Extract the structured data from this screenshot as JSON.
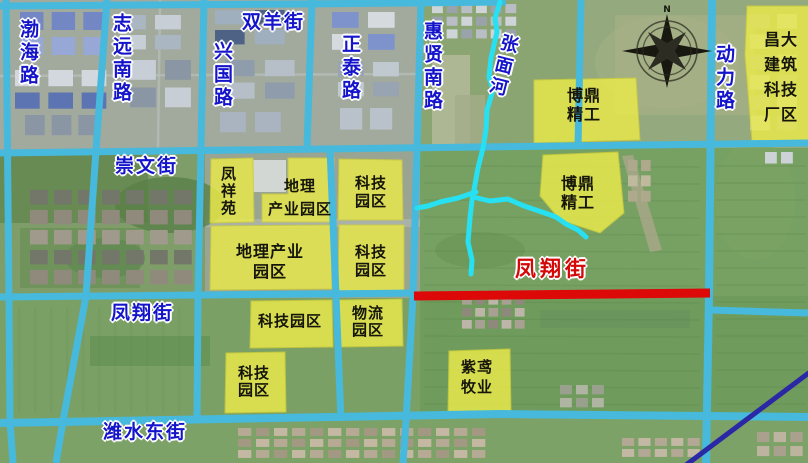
{
  "map": {
    "colors": {
      "road": "#46b9dc",
      "river": "#27e0f2",
      "red_road": "#dd0808",
      "street_text": "#1414cb",
      "street_text_red": "#d40808",
      "area_fill": "#e9e94b",
      "area_stroke": "#cdcd3a",
      "area_text": "#15150b",
      "highway": "#2b28a6",
      "compass": "#181810"
    },
    "streets": [
      {
        "id": "bohai-road",
        "text": "渤海路",
        "orient": "v",
        "x": 17,
        "y": 19,
        "size": 19
      },
      {
        "id": "zhiyuan-south-road",
        "text": "志远南路",
        "orient": "v",
        "x": 110,
        "y": 13,
        "size": 19
      },
      {
        "id": "xingguo-road",
        "text": "兴国路",
        "orient": "v",
        "x": 211,
        "y": 41,
        "size": 19
      },
      {
        "id": "shuangyang-street",
        "text": "双羊街",
        "orient": "h",
        "x": 242,
        "y": 11,
        "size": 19
      },
      {
        "id": "zhengtai-road",
        "text": "正泰路",
        "orient": "v",
        "x": 339,
        "y": 34,
        "size": 19
      },
      {
        "id": "huixian-south-road",
        "text": "惠贤南路",
        "orient": "v",
        "x": 421,
        "y": 21,
        "size": 19
      },
      {
        "id": "zhangmian-river",
        "text": "张面河",
        "orient": "v",
        "x": 499,
        "y": 34,
        "size": 18,
        "rotate": 14
      },
      {
        "id": "dongli-road",
        "text": "动力路",
        "orient": "v",
        "x": 713,
        "y": 44,
        "size": 19
      },
      {
        "id": "chongwen-street",
        "text": "崇文街",
        "orient": "h",
        "x": 115,
        "y": 155,
        "size": 19
      },
      {
        "id": "fengxiang-street-west",
        "text": "凤翔街",
        "orient": "h",
        "x": 111,
        "y": 302,
        "size": 19
      },
      {
        "id": "fengxiang-street-planned",
        "text": "凤翔街",
        "orient": "h",
        "x": 515,
        "y": 257,
        "size": 21,
        "red": true
      },
      {
        "id": "weishui-east-street",
        "text": "潍水东街",
        "orient": "h",
        "x": 103,
        "y": 421,
        "size": 19
      }
    ],
    "roads": [
      {
        "id": "shuangyang-street-road",
        "points": [
          [
            0,
            6
          ],
          [
            300,
            4
          ],
          [
            506,
            2
          ]
        ],
        "w": 7
      },
      {
        "id": "chongwen-street-road",
        "points": [
          [
            0,
            153
          ],
          [
            400,
            148
          ],
          [
            808,
            143
          ]
        ],
        "w": 7
      },
      {
        "id": "fengxiang-street-road",
        "points": [
          [
            0,
            297
          ],
          [
            416,
            293
          ]
        ],
        "w": 7
      },
      {
        "id": "east-connector-road",
        "points": [
          [
            711,
            310
          ],
          [
            808,
            313
          ]
        ],
        "w": 7
      },
      {
        "id": "weishui-east-street-road",
        "points": [
          [
            0,
            423
          ],
          [
            500,
            414
          ],
          [
            808,
            417
          ]
        ],
        "w": 8
      },
      {
        "id": "bohai-road-road",
        "points": [
          [
            6,
            0
          ],
          [
            9,
            300
          ],
          [
            10,
            421
          ],
          [
            13,
            463
          ]
        ],
        "w": 7
      },
      {
        "id": "zhiyuan-south-road-road",
        "points": [
          [
            107,
            0
          ],
          [
            96,
            150
          ],
          [
            86,
            296
          ],
          [
            63,
            421
          ],
          [
            56,
            463
          ]
        ],
        "w": 7
      },
      {
        "id": "xingguo-road-road",
        "points": [
          [
            204,
            0
          ],
          [
            201,
            148
          ],
          [
            198,
            296
          ],
          [
            197,
            421
          ]
        ],
        "w": 7
      },
      {
        "id": "zhengtai-road-north",
        "points": [
          [
            312,
            0
          ],
          [
            307,
            148
          ]
        ],
        "w": 7
      },
      {
        "id": "zhengtai-road-south",
        "points": [
          [
            330,
            148
          ],
          [
            336,
            296
          ],
          [
            341,
            421
          ]
        ],
        "w": 7
      },
      {
        "id": "huixian-south-road-road",
        "points": [
          [
            421,
            0
          ],
          [
            417,
            148
          ],
          [
            413,
            296
          ],
          [
            406,
            421
          ],
          [
            403,
            463
          ]
        ],
        "w": 7
      },
      {
        "id": "north-connector-road",
        "points": [
          [
            581,
            0
          ],
          [
            578,
            147
          ]
        ],
        "w": 7
      },
      {
        "id": "dongli-road-road",
        "points": [
          [
            712,
            0
          ],
          [
            709,
            296
          ],
          [
            706,
            463
          ]
        ],
        "w": 8
      }
    ],
    "red_road": {
      "id": "fengxiang-street-planned-road",
      "points": [
        [
          414,
          296
        ],
        [
          710,
          293
        ]
      ],
      "w": 9
    },
    "highway": {
      "id": "highway-diagonal",
      "points": [
        [
          810,
          372
        ],
        [
          686,
          465
        ]
      ],
      "w": 5
    },
    "river": {
      "id": "zhangmian-river-channel",
      "w": 5,
      "branches": [
        [
          [
            500,
            2
          ],
          [
            495,
            18
          ],
          [
            497,
            32
          ],
          [
            491,
            58
          ],
          [
            489,
            77
          ],
          [
            493,
            90
          ],
          [
            487,
            110
          ],
          [
            486,
            130
          ],
          [
            483,
            148
          ],
          [
            478,
            168
          ],
          [
            474,
            190
          ],
          [
            472,
            200
          ],
          [
            470,
            218
          ],
          [
            468,
            242
          ],
          [
            472,
            260
          ],
          [
            471,
            274
          ]
        ],
        [
          [
            476,
            192
          ],
          [
            458,
            198
          ],
          [
            440,
            202
          ],
          [
            428,
            206
          ],
          [
            417,
            208
          ]
        ],
        [
          [
            473,
            197
          ],
          [
            490,
            201
          ],
          [
            508,
            199
          ],
          [
            524,
            206
          ],
          [
            542,
            212
          ],
          [
            556,
            217
          ],
          [
            566,
            224
          ],
          [
            578,
            230
          ],
          [
            586,
            237
          ]
        ]
      ]
    },
    "areas": [
      {
        "id": "boding-jinggong-north",
        "label_lines": [
          "博鼎",
          "精工"
        ],
        "poly": [
          [
            534,
            80
          ],
          [
            636,
            78
          ],
          [
            640,
            140
          ],
          [
            534,
            143
          ]
        ],
        "label": {
          "cx": 584,
          "y": 86,
          "size": 16,
          "lh": 19
        }
      },
      {
        "id": "changda-construction",
        "label_lines": [
          "昌大",
          "建筑",
          "科技",
          "厂区"
        ],
        "poly": [
          [
            747,
            6
          ],
          [
            809,
            6
          ],
          [
            809,
            142
          ],
          [
            752,
            142
          ],
          [
            745,
            55
          ]
        ],
        "label": {
          "cx": 781,
          "y": 27,
          "size": 16,
          "lh": 25
        }
      },
      {
        "id": "boding-jinggong-south",
        "label_lines": [
          "博鼎",
          "精工"
        ],
        "poly": [
          [
            543,
            155
          ],
          [
            618,
            152
          ],
          [
            624,
            213
          ],
          [
            600,
            233
          ],
          [
            560,
            220
          ],
          [
            540,
            196
          ]
        ],
        "label": {
          "cx": 578,
          "y": 174,
          "size": 16,
          "lh": 19
        }
      },
      {
        "id": "fengxiang-yuan",
        "label_lines": [
          "凤",
          "祥",
          "苑"
        ],
        "poly": [
          [
            211,
            159
          ],
          [
            253,
            158
          ],
          [
            254,
            222
          ],
          [
            210,
            223
          ]
        ],
        "label": {
          "cx": 229,
          "y": 166,
          "size": 15,
          "lh": 17
        }
      },
      {
        "id": "dili-industrial-park-north",
        "label_lines": [
          "地理",
          "产业园区"
        ],
        "poly": [
          [
            288,
            158
          ],
          [
            334,
            158
          ],
          [
            334,
            222
          ],
          [
            262,
            222
          ],
          [
            262,
            194
          ],
          [
            288,
            194
          ]
        ],
        "label": {
          "cx": 300,
          "y": 175,
          "size": 15,
          "lh": 23
        }
      },
      {
        "id": "keji-park-a",
        "label_lines": [
          "科技",
          "园区"
        ],
        "poly": [
          [
            339,
            159
          ],
          [
            402,
            160
          ],
          [
            403,
            220
          ],
          [
            338,
            220
          ]
        ],
        "label": {
          "cx": 371,
          "y": 174,
          "size": 15,
          "lh": 18
        }
      },
      {
        "id": "dili-industrial-park-south",
        "label_lines": [
          "地理产业",
          "园区"
        ],
        "poly": [
          [
            211,
            226
          ],
          [
            331,
            225
          ],
          [
            332,
            289
          ],
          [
            210,
            290
          ]
        ],
        "label": {
          "cx": 270,
          "y": 242,
          "size": 16,
          "lh": 20
        }
      },
      {
        "id": "keji-park-b",
        "label_lines": [
          "科技",
          "园区"
        ],
        "poly": [
          [
            339,
            225
          ],
          [
            404,
            225
          ],
          [
            404,
            291
          ],
          [
            338,
            292
          ]
        ],
        "label": {
          "cx": 371,
          "y": 243,
          "size": 15,
          "lh": 18
        }
      },
      {
        "id": "keji-park-c",
        "label_lines": [
          "科技园区"
        ],
        "poly": [
          [
            251,
            301
          ],
          [
            332,
            300
          ],
          [
            333,
            347
          ],
          [
            250,
            348
          ]
        ],
        "label": {
          "cx": 290,
          "y": 313,
          "size": 15,
          "lh": 16
        }
      },
      {
        "id": "wuliu-park",
        "label_lines": [
          "物流",
          "园区"
        ],
        "poly": [
          [
            339,
            300
          ],
          [
            402,
            299
          ],
          [
            403,
            346
          ],
          [
            338,
            347
          ]
        ],
        "label": {
          "cx": 368,
          "y": 305,
          "size": 15,
          "lh": 17
        }
      },
      {
        "id": "keji-park-d",
        "label_lines": [
          "科技",
          "园区"
        ],
        "poly": [
          [
            226,
            353
          ],
          [
            285,
            352
          ],
          [
            286,
            412
          ],
          [
            225,
            413
          ]
        ],
        "label": {
          "cx": 254,
          "y": 365,
          "size": 15,
          "lh": 17
        }
      },
      {
        "id": "ziyuan-muye",
        "label_lines": [
          "紫鸢",
          "牧业"
        ],
        "poly": [
          [
            449,
            351
          ],
          [
            510,
            349
          ],
          [
            511,
            412
          ],
          [
            448,
            413
          ]
        ],
        "label": {
          "cx": 477,
          "y": 357,
          "size": 15,
          "lh": 20
        }
      }
    ],
    "compass": {
      "id": "compass-rose",
      "label": "N",
      "cx": 667,
      "cy": 51
    }
  }
}
